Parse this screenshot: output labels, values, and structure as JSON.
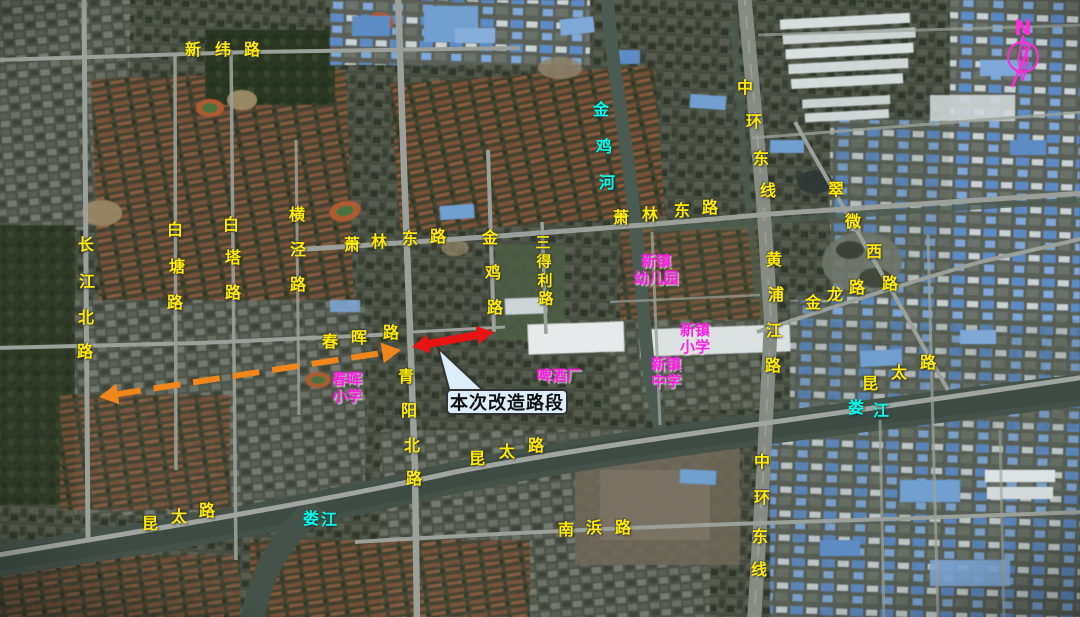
{
  "map": {
    "type": "satellite-map-figure",
    "colors": {
      "road_label": "#ffeb00",
      "water_label": "#00fff0",
      "poi_label": "#ff1ce4",
      "extension_arrow": "#f0861c",
      "renovation_arrow": "#e81414",
      "north_arrow": "#ff2bd8",
      "callout_fill": "#ddeefb",
      "callout_border": "#333333",
      "callout_text": "#111111"
    },
    "char_labels": [
      {
        "name": "xinwei-road-label",
        "color": "yellow",
        "size": 16,
        "text": "新纬路",
        "pos": [
          [
            193,
            50
          ],
          [
            223,
            50
          ],
          [
            252,
            50
          ]
        ]
      },
      {
        "name": "changjiang-north-road-label",
        "color": "yellow",
        "size": 16,
        "text": "长江北路",
        "pos": [
          [
            86,
            245
          ],
          [
            87,
            282
          ],
          [
            86,
            318
          ],
          [
            85,
            352
          ]
        ]
      },
      {
        "name": "baitang-road-label",
        "color": "yellow",
        "size": 16,
        "text": "白塘路",
        "pos": [
          [
            175,
            230
          ],
          [
            177,
            267
          ],
          [
            175,
            303
          ]
        ]
      },
      {
        "name": "baita-road-label",
        "color": "yellow",
        "size": 16,
        "text": "白塔路",
        "pos": [
          [
            231,
            225
          ],
          [
            233,
            258
          ],
          [
            233,
            293
          ]
        ]
      },
      {
        "name": "hengjing-road-label",
        "color": "yellow",
        "size": 16,
        "text": "横泾路",
        "pos": [
          [
            297,
            215
          ],
          [
            298,
            250
          ],
          [
            298,
            285
          ]
        ]
      },
      {
        "name": "xiaolin-east-road-label-west",
        "color": "yellow",
        "size": 16,
        "text": "萧林东路",
        "pos": [
          [
            352,
            245
          ],
          [
            379,
            242
          ],
          [
            410,
            239
          ],
          [
            438,
            237
          ]
        ]
      },
      {
        "name": "xiaolin-east-road-label-east",
        "color": "yellow",
        "size": 16,
        "text": "萧林东路",
        "pos": [
          [
            621,
            218
          ],
          [
            650,
            215
          ],
          [
            682,
            211
          ],
          [
            710,
            208
          ]
        ]
      },
      {
        "name": "jinji-road-label",
        "color": "yellow",
        "size": 16,
        "text": "金鸡路",
        "pos": [
          [
            490,
            238
          ],
          [
            493,
            273
          ],
          [
            495,
            308
          ]
        ]
      },
      {
        "name": "sandeli-road-label",
        "color": "yellow",
        "size": 15,
        "text": "三得利路",
        "pos": [
          [
            543,
            243
          ],
          [
            544,
            262
          ],
          [
            545,
            281
          ],
          [
            546,
            299
          ]
        ]
      },
      {
        "name": "chunhui-road-label",
        "color": "yellow",
        "size": 16,
        "text": "春晖路",
        "pos": [
          [
            330,
            342
          ],
          [
            359,
            338
          ],
          [
            391,
            333
          ]
        ]
      },
      {
        "name": "qingyang-north-road-label",
        "color": "yellow",
        "size": 16,
        "text": "青阳北路",
        "pos": [
          [
            406,
            377
          ],
          [
            409,
            411
          ],
          [
            412,
            446
          ],
          [
            414,
            479
          ]
        ]
      },
      {
        "name": "zhonghuan-east-line-label-north",
        "color": "yellow",
        "size": 16,
        "text": "中环东线",
        "pos": [
          [
            745,
            88
          ],
          [
            754,
            122
          ],
          [
            761,
            159
          ],
          [
            768,
            191
          ]
        ]
      },
      {
        "name": "huangpujiang-road-label",
        "color": "yellow",
        "size": 16,
        "text": "黄浦江路",
        "pos": [
          [
            774,
            260
          ],
          [
            776,
            295
          ],
          [
            774,
            331
          ],
          [
            773,
            366
          ]
        ]
      },
      {
        "name": "cuiwei-west-road-label",
        "color": "yellow",
        "size": 16,
        "text": "翠微西路",
        "pos": [
          [
            836,
            190
          ],
          [
            853,
            222
          ],
          [
            874,
            252
          ],
          [
            890,
            284
          ]
        ]
      },
      {
        "name": "jinlong-road-label",
        "color": "yellow",
        "size": 16,
        "text": "金龙路",
        "pos": [
          [
            813,
            303
          ],
          [
            835,
            295
          ],
          [
            857,
            288
          ]
        ]
      },
      {
        "name": "kuntai-road-label-east",
        "color": "yellow",
        "size": 16,
        "text": "昆太路",
        "pos": [
          [
            870,
            384
          ],
          [
            899,
            373
          ],
          [
            928,
            363
          ]
        ]
      },
      {
        "name": "kuntai-road-label-center",
        "color": "yellow",
        "size": 16,
        "text": "昆太路",
        "pos": [
          [
            477,
            459
          ],
          [
            507,
            452
          ],
          [
            536,
            446
          ]
        ]
      },
      {
        "name": "kuntai-road-label-west",
        "color": "yellow",
        "size": 16,
        "text": "昆太路",
        "pos": [
          [
            150,
            524
          ],
          [
            179,
            517
          ],
          [
            207,
            511
          ]
        ]
      },
      {
        "name": "nanbang-road-label",
        "color": "yellow",
        "size": 16,
        "text": "南浜路",
        "pos": [
          [
            566,
            530
          ],
          [
            594,
            528
          ],
          [
            623,
            528
          ]
        ]
      },
      {
        "name": "zhonghuan-east-line-label-south",
        "color": "yellow",
        "size": 16,
        "text": "中环东线",
        "pos": [
          [
            762,
            462
          ],
          [
            762,
            498
          ],
          [
            760,
            537
          ],
          [
            759,
            570
          ]
        ]
      },
      {
        "name": "jinji-river-label",
        "color": "cyan",
        "size": 16,
        "text": "金鸡河",
        "pos": [
          [
            601,
            110
          ],
          [
            604,
            147
          ],
          [
            607,
            183
          ]
        ]
      },
      {
        "name": "loujiang-river-label-west",
        "color": "cyan",
        "size": 16,
        "text": "娄江",
        "pos": [
          [
            311,
            519
          ],
          [
            329,
            520
          ]
        ]
      },
      {
        "name": "loujiang-river-label-east",
        "color": "cyan",
        "size": 16,
        "text": "娄江",
        "pos": [
          [
            856,
            408
          ],
          [
            881,
            411
          ]
        ]
      }
    ],
    "block_labels": [
      {
        "name": "chunhui-primary-school-label",
        "color": "magenta",
        "size": 15,
        "lines": [
          "春晖",
          "小学"
        ],
        "x": 347,
        "y": 388
      },
      {
        "name": "xinzhen-kindergarten-label",
        "color": "magenta",
        "size": 15,
        "lines": [
          "新镇",
          "幼儿园"
        ],
        "x": 656,
        "y": 270
      },
      {
        "name": "xinzhen-primary-school-label",
        "color": "magenta",
        "size": 15,
        "lines": [
          "新镇",
          "小学"
        ],
        "x": 695,
        "y": 339
      },
      {
        "name": "xinzhen-middle-school-label",
        "color": "magenta",
        "size": 15,
        "lines": [
          "新镇",
          "中学"
        ],
        "x": 666,
        "y": 373
      },
      {
        "name": "brewery-label",
        "color": "magenta",
        "size": 15,
        "lines": [
          "啤酒厂"
        ],
        "x": 559,
        "y": 376
      }
    ],
    "annotations": {
      "arrows": [
        {
          "name": "planned-extension-arrow",
          "color": "#f0861c",
          "x1": 99,
          "y1": 397,
          "x2": 401,
          "y2": 350,
          "width": 6,
          "dash": "27 13",
          "head": 19
        },
        {
          "name": "renovation-segment-arrow",
          "color": "#e81414",
          "x1": 412,
          "y1": 347,
          "x2": 494,
          "y2": 332,
          "width": 8,
          "dash": "",
          "head": 17
        }
      ],
      "callout": {
        "name": "renovation-callout",
        "text": "本次改造路段",
        "x": 446,
        "y": 389,
        "w": 122,
        "h": 26,
        "tip_x": 438,
        "tip_y": 348
      },
      "north_arrow": {
        "label": "N",
        "x": 1023,
        "y": 57
      }
    }
  }
}
